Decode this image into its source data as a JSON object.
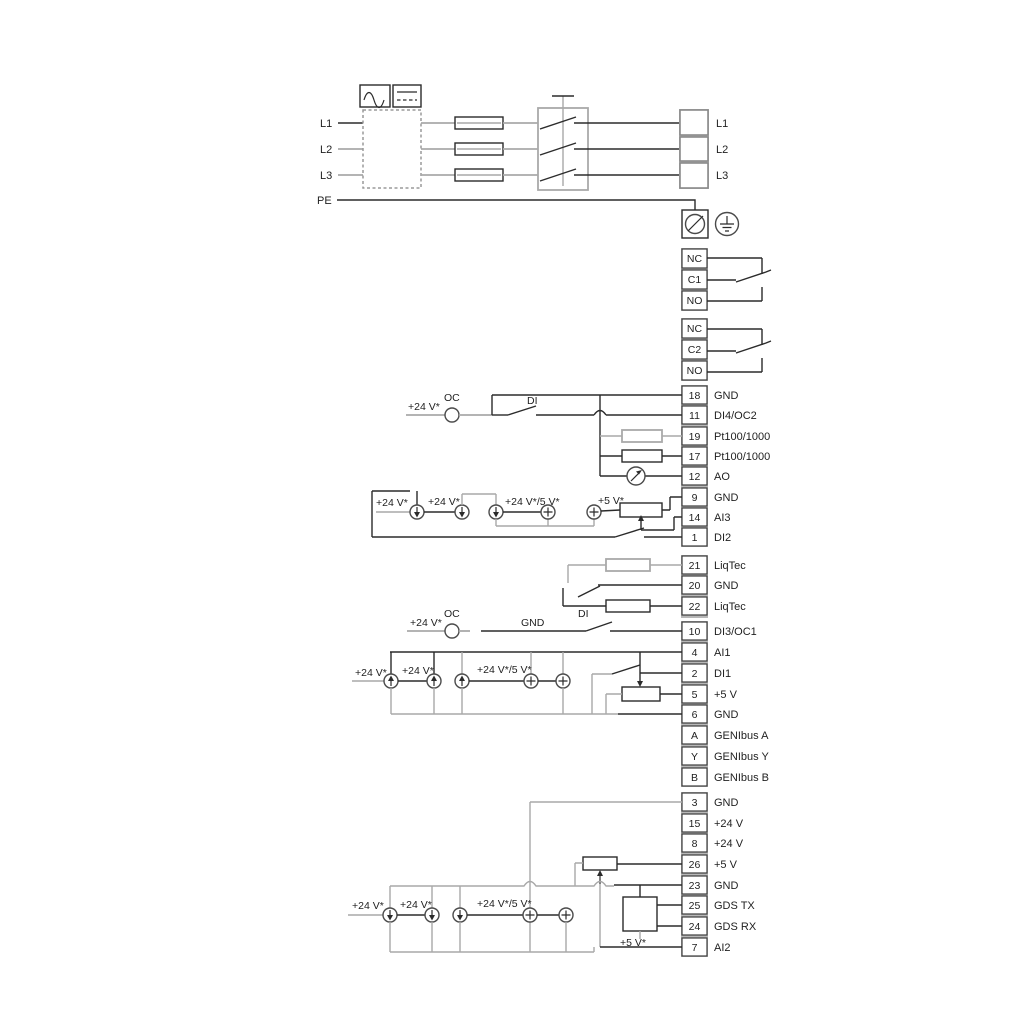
{
  "colors": {
    "wire": "#2b2b2b",
    "wire_alt": "#a9a9a9",
    "background": "#ffffff"
  },
  "power": {
    "in": [
      "L1",
      "L2",
      "L3",
      "PE"
    ],
    "out": [
      "L1",
      "L2",
      "L3"
    ]
  },
  "relay1": [
    "NC",
    "C1",
    "NO"
  ],
  "relay2": [
    "NC",
    "C2",
    "NO"
  ],
  "groupA": {
    "terminals": [
      [
        "18",
        "GND"
      ],
      [
        "11",
        "DI4/OC2"
      ],
      [
        "19",
        "Pt100/1000"
      ],
      [
        "17",
        "Pt100/1000"
      ],
      [
        "12",
        "AO"
      ],
      [
        "9",
        "GND"
      ],
      [
        "14",
        "AI3"
      ],
      [
        "1",
        "DI2"
      ]
    ],
    "ann": {
      "v24a": "+24 V*",
      "oc": "OC",
      "di": "DI",
      "v24b": "+24 V*",
      "v24c": "+24 V*",
      "v245": "+24 V*/5 V*",
      "v5": "+5 V*"
    }
  },
  "liqtec": {
    "terminals": [
      [
        "21",
        "LiqTec"
      ],
      [
        "20",
        "GND"
      ],
      [
        "22",
        "LiqTec"
      ]
    ]
  },
  "groupB": {
    "terminals": [
      [
        "10",
        "DI3/OC1"
      ],
      [
        "4",
        "AI1"
      ],
      [
        "2",
        "DI1"
      ],
      [
        "5",
        "+5 V"
      ],
      [
        "6",
        "GND"
      ],
      [
        "A",
        "GENIbus A"
      ],
      [
        "Y",
        "GENIbus Y"
      ],
      [
        "B",
        "GENIbus B"
      ]
    ],
    "ann": {
      "v24a": "+24 V*",
      "oc": "OC",
      "gnd": "GND",
      "di": "DI",
      "v24b": "+24 V*",
      "v24c": "+24 V*",
      "v245": "+24 V*/5 V*"
    }
  },
  "groupC": {
    "terminals": [
      [
        "3",
        "GND"
      ],
      [
        "15",
        "+24 V"
      ],
      [
        "8",
        "+24 V"
      ],
      [
        "26",
        "+5 V"
      ],
      [
        "23",
        "GND"
      ],
      [
        "25",
        "GDS TX"
      ],
      [
        "24",
        "GDS RX"
      ],
      [
        "7",
        "AI2"
      ]
    ],
    "ann": {
      "v24a": "+24 V*",
      "v24b": "+24 V*",
      "v245": "+24 V*/5 V*",
      "v5": "+5 V*"
    }
  }
}
